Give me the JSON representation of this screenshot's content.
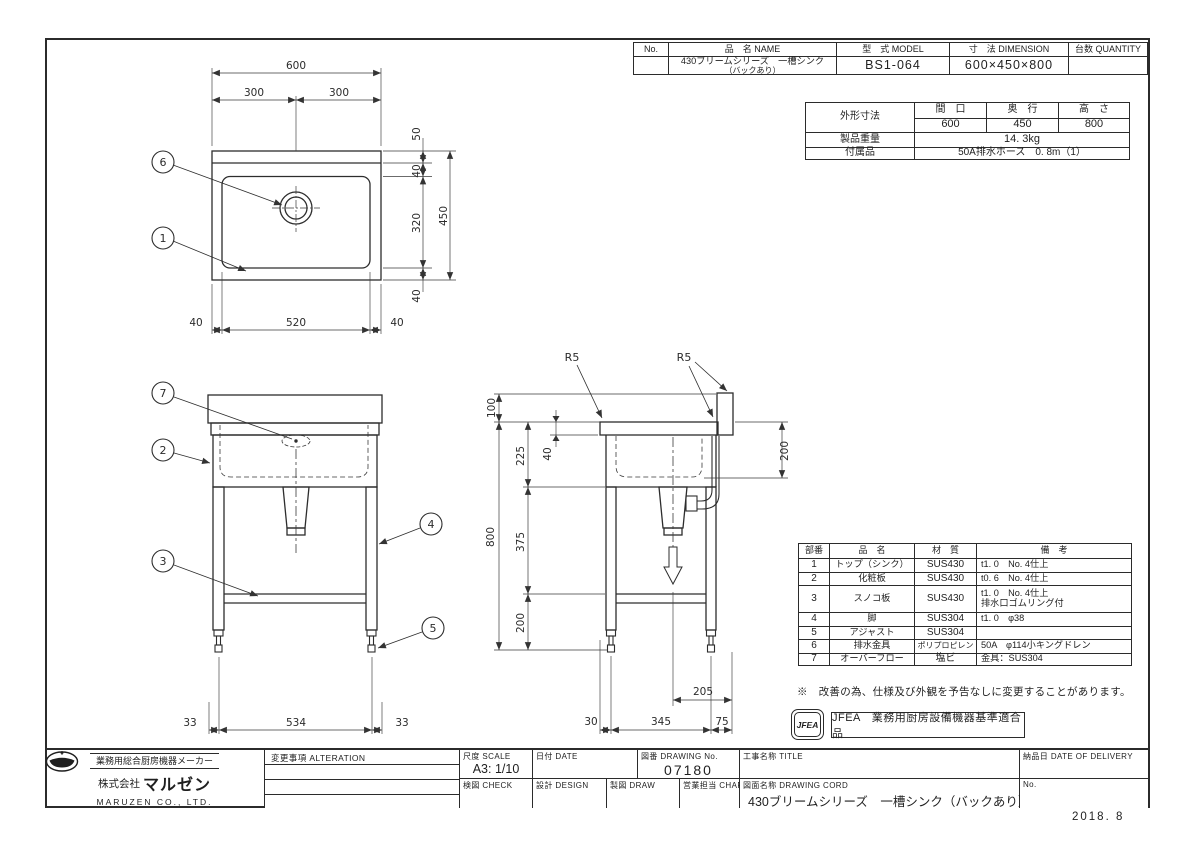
{
  "doc": {
    "date_code": "2018. 8",
    "note": "※　改善の為、仕様及び外観を予告なしに変更することがあります。",
    "jfea_stamp": "JFEA",
    "jfea_label": "JFEA　業務用厨房設備機器基準適合品"
  },
  "header_table": {
    "col_no": "No.",
    "col_name": "品　名 NAME",
    "col_model": "型　式 MODEL",
    "col_dimension": "寸　法 DIMENSION",
    "col_quantity": "台数 QUANTITY",
    "no_value": "",
    "name_line1": "430ブリームシリーズ　一槽シンク",
    "name_line2": "（バックあり）",
    "model": "BS1-064",
    "dimension": "600×450×800",
    "quantity_value": ""
  },
  "spec_table": {
    "outer_label": "外形寸法",
    "col_width": "間　口",
    "col_depth": "奥　行",
    "col_height": "高　さ",
    "width": "600",
    "depth": "450",
    "height": "800",
    "weight_label": "製品重量",
    "weight": "14. 3kg",
    "accessory_label": "付属品",
    "accessory": "50A排水ホース　0. 8m（1）"
  },
  "parts_table": {
    "col_no": "部番",
    "col_name": "品　名",
    "col_material": "材　質",
    "col_note": "備　考",
    "rows": [
      {
        "no": "1",
        "name": "トップ（シンク）",
        "material": "SUS430",
        "note": "t1. 0　No. 4仕上"
      },
      {
        "no": "2",
        "name": "化粧板",
        "material": "SUS430",
        "note": "t0. 6　No. 4仕上"
      },
      {
        "no": "3",
        "name": "スノコ板",
        "material": "SUS430",
        "note": "t1. 0　No. 4仕上",
        "note2": "排水口ゴムリング付"
      },
      {
        "no": "4",
        "name": "脚",
        "material": "SUS304",
        "note": "t1. 0　φ38"
      },
      {
        "no": "5",
        "name": "アジャスト",
        "material": "SUS304",
        "note": ""
      },
      {
        "no": "6",
        "name": "排水金具",
        "material": "ポリプロピレン",
        "note": "50A　φ114小キングドレン"
      },
      {
        "no": "7",
        "name": "オーバーフロー",
        "material": "塩ビ",
        "note": "金具：SUS304"
      }
    ]
  },
  "title_block": {
    "maker_tagline": "業務用総合厨房機器メーカー",
    "company_prefix": "株式会社",
    "company_name": "マルゼン",
    "company_en": "MARUZEN CO., LTD.",
    "alteration_label": "変更事項  ALTERATION",
    "scale_label": "尺度  SCALE",
    "scale_value": "A3: 1/10",
    "date_label": "日付  DATE",
    "drawing_no_label": "図番  DRAWING No.",
    "drawing_no": "07180",
    "project_label": "工事名称  TITLE",
    "check_label": "検図  CHECK",
    "design_label": "設計  DESIGN",
    "draw_label": "製図  DRAW",
    "charge_label": "営業担当 CHARGE",
    "drawing_name_label": "図面名称  DRAWING CORD",
    "drawing_name": "430ブリームシリーズ　一槽シンク（バックあり）",
    "delivery_label": "納品日  DATE OF DELIVERY",
    "no_label": "No."
  },
  "views": {
    "top": {
      "width": "600",
      "width_left": "300",
      "width_right": "300",
      "back_gap": "50",
      "rim": "40",
      "sink_depth": "320",
      "depth": "450",
      "front_rim": "40",
      "bottom_left": "40",
      "bottom_center": "520",
      "bottom_right": "40",
      "balloon_drain": "6",
      "balloon_sink": "1"
    },
    "front": {
      "foot_left": "33",
      "foot_center": "534",
      "foot_right": "33",
      "balloon_overflow": "7",
      "balloon_panel": "2",
      "balloon_shelf": "3",
      "balloon_leg": "4",
      "balloon_adjuster": "5"
    },
    "side": {
      "radius_left": "R5",
      "radius_right": "R5",
      "back_height": "100",
      "top_to_sink": "225",
      "rim": "40",
      "total_height": "800",
      "sink_to_shelf": "375",
      "shelf_to_floor": "200",
      "back_depth": "200",
      "drain_offset": "205",
      "front_offset": "30",
      "leg_span": "345",
      "back_offset": "75"
    }
  }
}
